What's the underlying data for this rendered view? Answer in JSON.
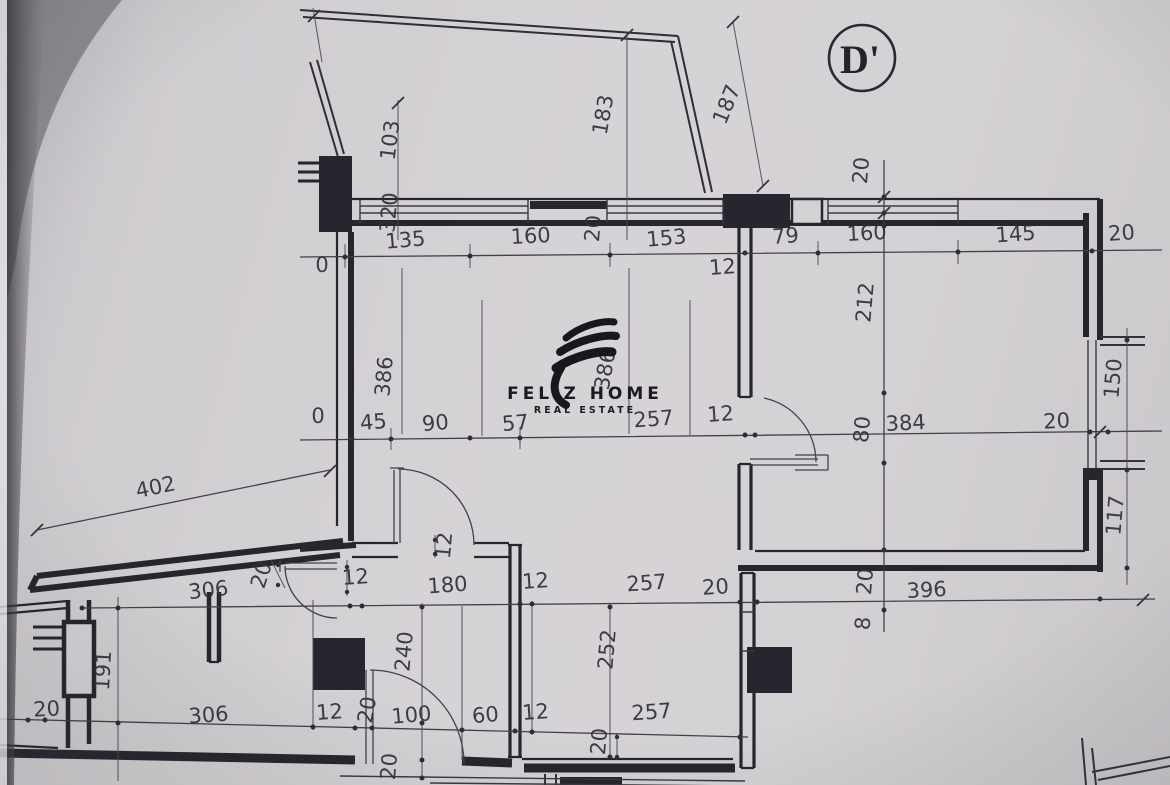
{
  "section_marker": {
    "label": "D'"
  },
  "logo": {
    "name": "FELIZ HOME",
    "subtitle": "REAL ESTATE"
  },
  "colors": {
    "paper": "#d3d0d3",
    "ink": "#26262e",
    "dim_text": "#30303a"
  },
  "dimensions": [
    {
      "text": "103",
      "x": 397,
      "y": 141,
      "rot": -83
    },
    {
      "text": "183",
      "x": 610,
      "y": 116,
      "rot": -80
    },
    {
      "text": "187",
      "x": 733,
      "y": 107,
      "rot": -68
    },
    {
      "text": "20",
      "x": 868,
      "y": 171,
      "rot": -85
    },
    {
      "text": "320",
      "x": 396,
      "y": 213,
      "rot": -85
    },
    {
      "text": "135",
      "x": 406,
      "y": 247,
      "rot": -5
    },
    {
      "text": "160",
      "x": 531,
      "y": 243,
      "rot": -3
    },
    {
      "text": "20",
      "x": 600,
      "y": 229,
      "rot": -85
    },
    {
      "text": "153",
      "x": 667,
      "y": 245,
      "rot": -5
    },
    {
      "text": "79",
      "x": 786,
      "y": 243,
      "rot": -4
    },
    {
      "text": "160",
      "x": 867,
      "y": 240,
      "rot": -3
    },
    {
      "text": "145",
      "x": 1016,
      "y": 241,
      "rot": -4
    },
    {
      "text": "20",
      "x": 1122,
      "y": 240,
      "rot": -4
    },
    {
      "text": "0",
      "x": 322,
      "y": 272,
      "rot": 0,
      "size": 19
    },
    {
      "text": "12",
      "x": 723,
      "y": 274,
      "rot": -4
    },
    {
      "text": "386",
      "x": 391,
      "y": 377,
      "rot": -85
    },
    {
      "text": "386",
      "x": 612,
      "y": 371,
      "rot": -80
    },
    {
      "text": "212",
      "x": 872,
      "y": 303,
      "rot": -85
    },
    {
      "text": "0",
      "x": 318,
      "y": 423,
      "rot": 0,
      "size": 19
    },
    {
      "text": "45",
      "x": 374,
      "y": 429,
      "rot": -5
    },
    {
      "text": "90",
      "x": 436,
      "y": 430,
      "rot": -5
    },
    {
      "text": "57",
      "x": 516,
      "y": 430,
      "rot": -5
    },
    {
      "text": "257",
      "x": 654,
      "y": 426,
      "rot": -4
    },
    {
      "text": "12",
      "x": 721,
      "y": 421,
      "rot": -4
    },
    {
      "text": "80",
      "x": 869,
      "y": 430,
      "rot": -85
    },
    {
      "text": "384",
      "x": 906,
      "y": 430,
      "rot": -3
    },
    {
      "text": "20",
      "x": 1057,
      "y": 428,
      "rot": -3
    },
    {
      "text": "150",
      "x": 1120,
      "y": 379,
      "rot": -85
    },
    {
      "text": "117",
      "x": 1122,
      "y": 516,
      "rot": -85
    },
    {
      "text": "402",
      "x": 157,
      "y": 494,
      "rot": -12
    },
    {
      "text": "20",
      "x": 268,
      "y": 577,
      "rot": -72
    },
    {
      "text": "306",
      "x": 209,
      "y": 597,
      "rot": -6
    },
    {
      "text": "12",
      "x": 356,
      "y": 584,
      "rot": -4
    },
    {
      "text": "12",
      "x": 451,
      "y": 546,
      "rot": -85
    },
    {
      "text": "180",
      "x": 448,
      "y": 592,
      "rot": -4
    },
    {
      "text": "12",
      "x": 536,
      "y": 588,
      "rot": -4
    },
    {
      "text": "257",
      "x": 647,
      "y": 590,
      "rot": -4
    },
    {
      "text": "20",
      "x": 716,
      "y": 594,
      "rot": -4
    },
    {
      "text": "396",
      "x": 927,
      "y": 597,
      "rot": -3
    },
    {
      "text": "20",
      "x": 872,
      "y": 582,
      "rot": -85
    },
    {
      "text": "8",
      "x": 870,
      "y": 624,
      "rot": -85,
      "size": 20
    },
    {
      "text": "191",
      "x": 110,
      "y": 671,
      "rot": -87
    },
    {
      "text": "240",
      "x": 411,
      "y": 652,
      "rot": -85
    },
    {
      "text": "252",
      "x": 614,
      "y": 650,
      "rot": -85
    },
    {
      "text": "20",
      "x": 47,
      "y": 716,
      "rot": -3
    },
    {
      "text": "306",
      "x": 209,
      "y": 722,
      "rot": -4
    },
    {
      "text": "12",
      "x": 330,
      "y": 719,
      "rot": -4
    },
    {
      "text": "20",
      "x": 374,
      "y": 711,
      "rot": -80
    },
    {
      "text": "100",
      "x": 412,
      "y": 722,
      "rot": -5
    },
    {
      "text": "60",
      "x": 486,
      "y": 722,
      "rot": -5
    },
    {
      "text": "12",
      "x": 536,
      "y": 719,
      "rot": -4
    },
    {
      "text": "257",
      "x": 652,
      "y": 719,
      "rot": -4
    },
    {
      "text": "20",
      "x": 606,
      "y": 742,
      "rot": -85
    },
    {
      "text": "20",
      "x": 396,
      "y": 767,
      "rot": -85
    }
  ]
}
